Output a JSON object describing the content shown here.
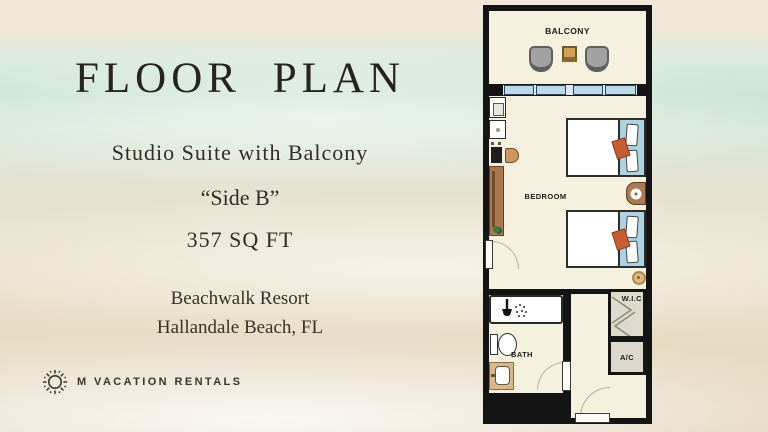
{
  "left_panel": {
    "title": "FLOOR PLAN",
    "subtitle": "Studio Suite with Balcony",
    "side_label": "“Side B”",
    "area": "357 SQ FT",
    "resort_name": "Beachwalk Resort",
    "resort_location": "Hallandale Beach, FL",
    "brand": {
      "icon": "sun-icon",
      "name": "M VACATION RENTALS"
    }
  },
  "floor_plan": {
    "rooms": {
      "balcony": {
        "label": "BALCONY"
      },
      "bedroom": {
        "label": "BEDROOM"
      },
      "bath": {
        "label": "BATH"
      },
      "wic": {
        "label": "W.I.C"
      },
      "ac": {
        "label": "A/C"
      }
    },
    "furniture_icons": [
      "balcony-chair",
      "balcony-table",
      "sliding-window",
      "kitchenette-appliance",
      "cooktop",
      "mini-fridge",
      "stool",
      "wardrobe-counter",
      "plant",
      "double-bed",
      "pillow",
      "accent-pillow",
      "nightstand-lamp",
      "side-table",
      "shower",
      "shower-head",
      "toilet",
      "sink-vanity",
      "closet-rods",
      "connecting-door",
      "bath-door",
      "entry-door"
    ],
    "colors": {
      "floor": "#f6f0df",
      "wall": "#141414",
      "window_blue": "#bcd9e8",
      "headboard_blue": "#aed3e3",
      "pillow_accent": "#c55f33",
      "wood": "#a97a52",
      "tan": "#cfa055",
      "chair_gray": "#a2a2a2",
      "closet_bg": "#dedbcc",
      "ac_bg": "#dcd9cc"
    }
  }
}
